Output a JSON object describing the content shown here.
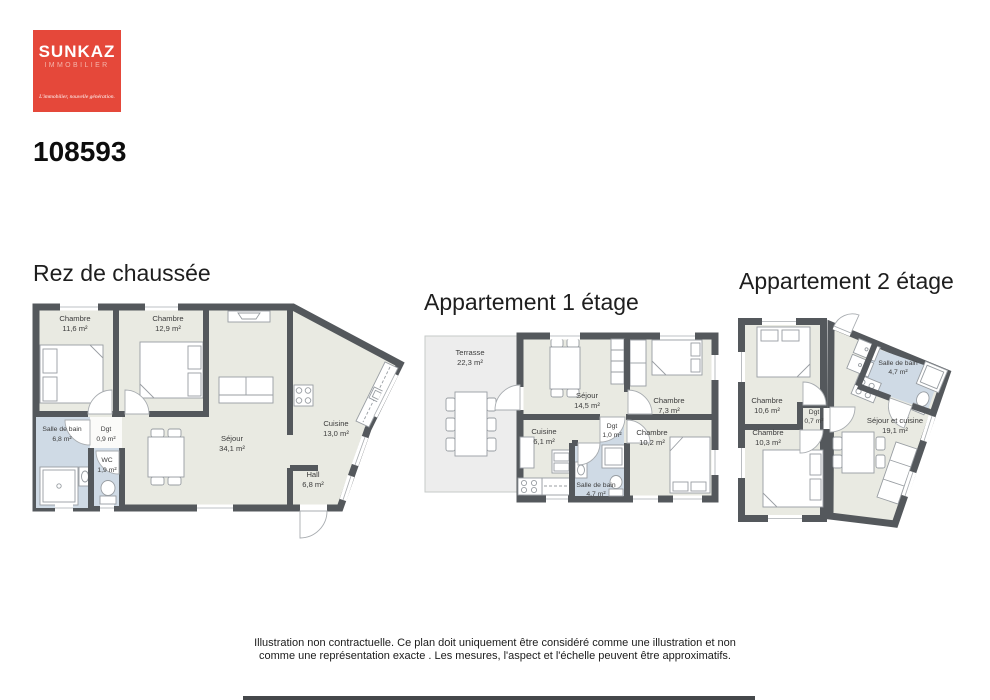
{
  "logo": {
    "brand": "SUNKAZ",
    "subtitle": "IMMOBILIER",
    "tagline": "L'immobilier, nouvelle génération."
  },
  "reference": "108593",
  "plans": [
    {
      "title": "Rez de chaussée",
      "rooms": [
        {
          "name": "Chambre",
          "area": "11,6 m²"
        },
        {
          "name": "Chambre",
          "area": "12,9 m²"
        },
        {
          "name": "Séjour",
          "area": "34,1 m²"
        },
        {
          "name": "Cuisine",
          "area": "13,0 m²"
        },
        {
          "name": "Hall",
          "area": "6,8 m²"
        },
        {
          "name": "Salle de bain",
          "area": "6,8 m²"
        },
        {
          "name": "Dgt",
          "area": "0,9 m²"
        },
        {
          "name": "WC",
          "area": "1,9 m²"
        }
      ]
    },
    {
      "title": "Appartement 1 étage",
      "rooms": [
        {
          "name": "Terrasse",
          "area": "22,3 m²"
        },
        {
          "name": "Séjour",
          "area": "14,5 m²"
        },
        {
          "name": "Chambre",
          "area": "7,3 m²"
        },
        {
          "name": "Cuisine",
          "area": "6,1 m²"
        },
        {
          "name": "Dgt",
          "area": "1,0 m²"
        },
        {
          "name": "Chambre",
          "area": "10,2 m²"
        },
        {
          "name": "Salle de bain",
          "area": "4,7 m²"
        }
      ]
    },
    {
      "title": "Appartement 2 étage",
      "rooms": [
        {
          "name": "Chambre",
          "area": "10,6 m²"
        },
        {
          "name": "Chambre",
          "area": "10,3 m²"
        },
        {
          "name": "Dgt",
          "area": "0,7 m²"
        },
        {
          "name": "Salle de bain",
          "area": "4,7 m²"
        },
        {
          "name": "Séjour et cuisine",
          "area": "19,1 m²"
        }
      ]
    }
  ],
  "footer": {
    "line1": "Illustration non contractuelle. Ce plan doit uniquement être considéré comme une illustration et non",
    "line2": "comme une représentation exacte . Les mesures, l'aspect et l'échelle peuvent être approximatifs."
  },
  "colors": {
    "wall": "#54585C",
    "floor": "#E9EAE2",
    "wet_room": "#CFDAE5",
    "terrace": "#EDEDED",
    "brand_red": "#E5483A"
  }
}
